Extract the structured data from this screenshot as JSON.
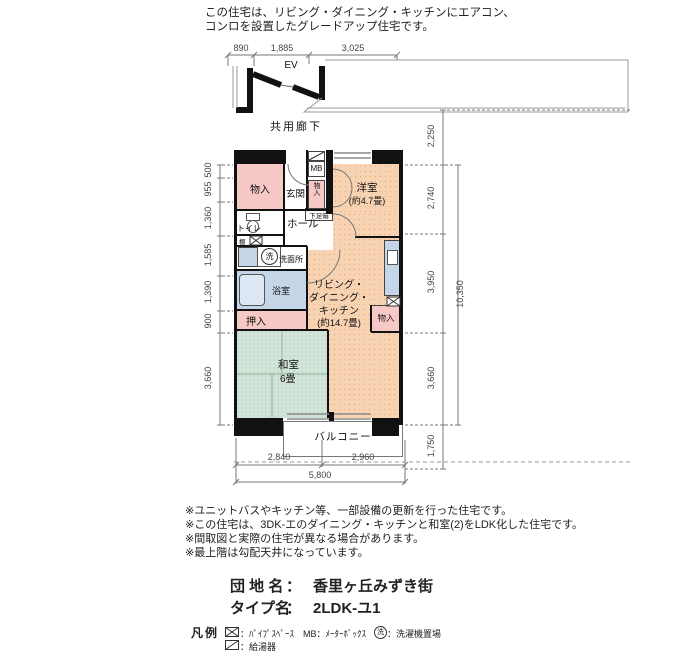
{
  "header_note": {
    "line1": "この住宅は、リビング・ダイニング・キッチンにエアコン、",
    "line2": "コンロを設置したグレードアップ住宅です。"
  },
  "plan": {
    "ev": "EV",
    "corridor": "共用廊下",
    "balcony": "バルコニー",
    "rooms": {
      "storage_top": "物入",
      "entrance": "玄関",
      "mb": "MB",
      "storage_mid": "物入",
      "western_name": "洋室",
      "western_size": "(約4.7畳)",
      "shoe_box": "下足箱",
      "hall": "ホール",
      "toilet": "トイレ",
      "shelf": "棚",
      "wash_symbol": "洗",
      "washroom": "洗面所",
      "bath": "浴室",
      "closet": "押入",
      "japanese_name": "和室",
      "japanese_size": "6畳",
      "ldk_line1": "リビング・",
      "ldk_line2": "ダイニング・",
      "ldk_line3": "キッチン",
      "ldk_line4": "(約14.7畳)",
      "storage_right": "物入"
    }
  },
  "dimensions": {
    "top": [
      "890",
      "1,885",
      "3,025"
    ],
    "left": [
      "500",
      "955",
      "1,360",
      "1,585",
      "1,390",
      "900",
      "3,660"
    ],
    "right": [
      "2,250",
      "2,740",
      "3,950",
      "3,660",
      "1,750"
    ],
    "right_total": "10,350",
    "bottom": [
      "2,840",
      "2,960"
    ],
    "bottom_total": "5,800"
  },
  "notes": [
    "※ユニットバスやキッチン等、一部設備の更新を行った住宅です。",
    "※この住宅は、3DK-エのダイニング・キッチンと和室(2)をLDK化した住宅です。",
    "※間取図と実際の住宅が異なる場合があります。",
    "※最上階は勾配天井になっています。"
  ],
  "estate": {
    "name_label": "団 地 名",
    "name_sep": "：",
    "name": "香里ヶ丘みずき街",
    "type_label": "タイプ名",
    "type_sep": "：",
    "type": "2LDK-ユ1"
  },
  "legend": {
    "title": "凡例",
    "pipe_space": "：ﾊﾟｲﾌﾟｽﾍﾟｰｽ",
    "meter_box": "MB：ﾒｰﾀｰﾎﾞｯｸｽ",
    "wash_place": "：洗濯機置場",
    "wash_char": "洗",
    "heater": "：給湯器"
  },
  "colors": {
    "room_warm": "#f8d3b2",
    "tatami": "#d3e4d8",
    "wet_blue": "#c5d6e9",
    "closet_pink": "#f7c9c6",
    "wall": "#111111"
  }
}
